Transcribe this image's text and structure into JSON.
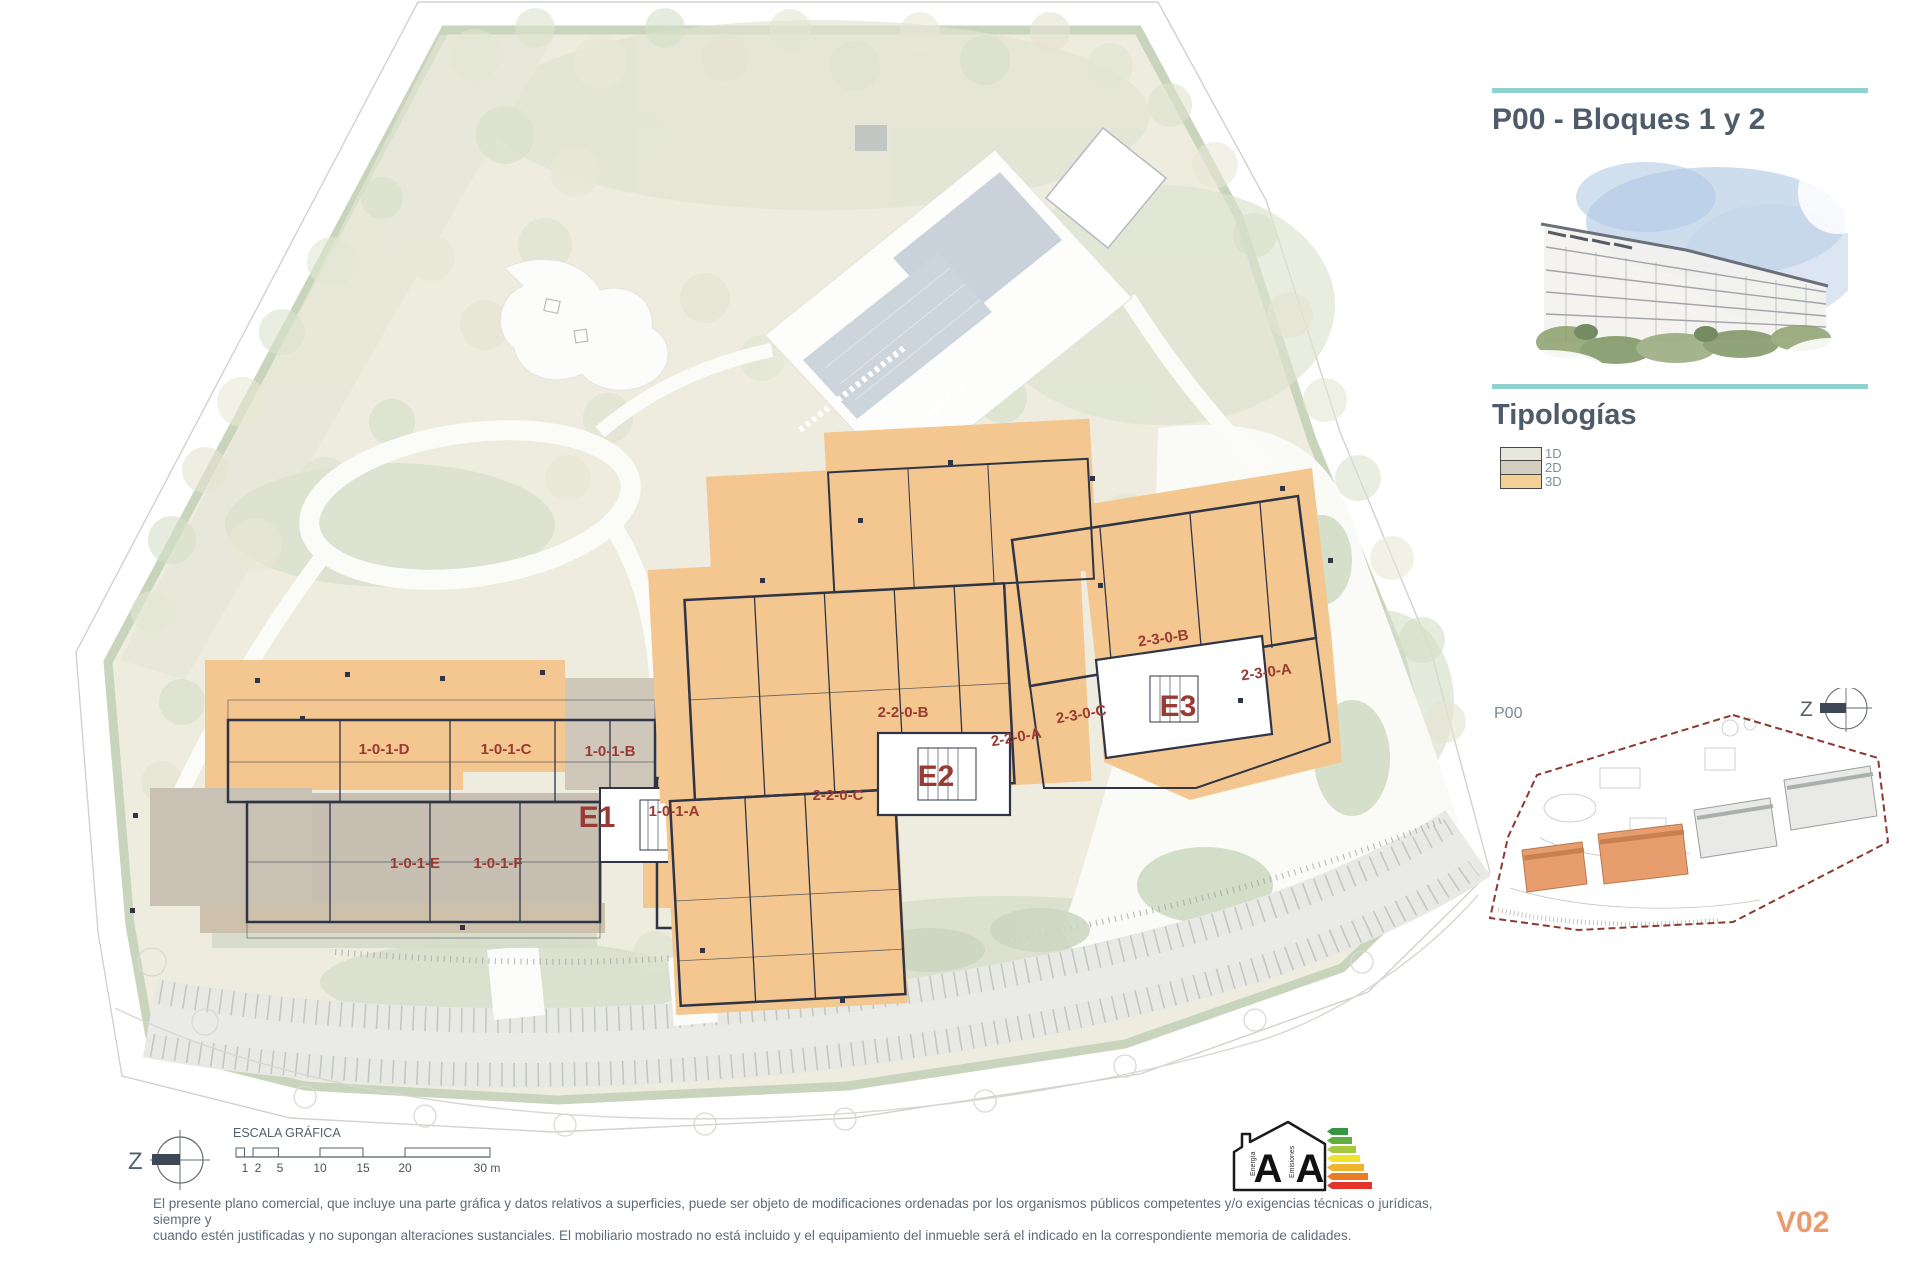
{
  "panel": {
    "title": "P00 - Bloques 1 y 2",
    "typologies_heading": "Tipologías",
    "legend": [
      {
        "label": "1D",
        "color": "#e7e8dd"
      },
      {
        "label": "2D",
        "color": "#d4cec1"
      },
      {
        "label": "3D",
        "color": "#f4cf96"
      }
    ],
    "keyplan_label": "P00",
    "version": "V02"
  },
  "compass": {
    "letter": "Z"
  },
  "scalebar": {
    "title": "ESCALA GRÁFICA",
    "ticks": [
      "1",
      "2",
      "5",
      "10",
      "15",
      "20",
      "30 m"
    ]
  },
  "units": {
    "e1": "E1",
    "e2": "E2",
    "e3": "E3",
    "u101d": "1-0-1-D",
    "u101c": "1-0-1-C",
    "u101b": "1-0-1-B",
    "u101a": "1-0-1-A",
    "u101e": "1-0-1-E",
    "u101f": "1-0-1-F",
    "u220b": "2-2-0-B",
    "u220a": "2-2-0-A",
    "u220c": "2-2-0-C",
    "u230c": "2-3-0-C",
    "u230b": "2-3-0-B",
    "u230a": "2-3-0-A"
  },
  "energy": {
    "energia_word": "Energía",
    "emisiones_word": "Emisiones",
    "energia_letter": "A",
    "emisiones_letter": "A"
  },
  "disclaimer": {
    "line1": "El presente plano comercial, que incluye una parte gráfica y datos relativos a superficies, puede ser objeto de modificaciones ordenadas por los organismos públicos competentes y/o exigencias técnicas o jurídicas, siempre y",
    "line2": "cuando estén justificadas y no supongan alteraciones sustanciales. El mobiliario mostrado no está incluido y el equipamiento del inmueble será el indicado en la correspondiente memoria de calidades."
  },
  "colors": {
    "accent_teal": "#8ed1ce",
    "title_text": "#4e5c6a",
    "unit_label_red": "#9a3b33",
    "typology_3d_orange": "#f4cf96",
    "version_orange": "#ea9a6d"
  }
}
